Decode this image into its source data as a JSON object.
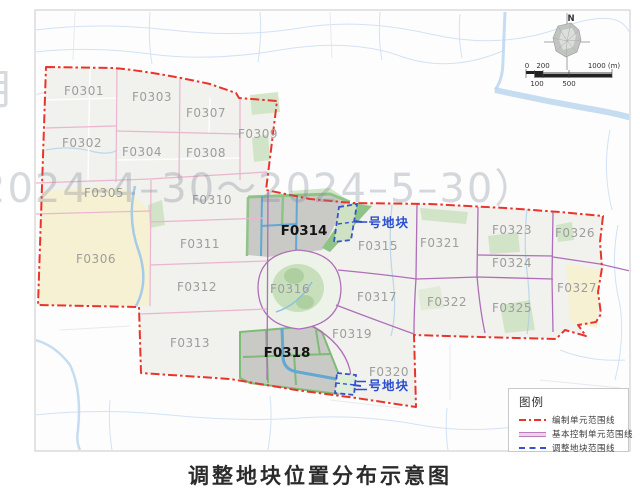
{
  "title": "调整地块位置分布示意图",
  "map": {
    "north_label": "N",
    "watermark": {
      "main": "（2024–4–30～2024–5–30）",
      "left_fragment": "月"
    },
    "parcels": [
      {
        "id": "F0301",
        "label": "F0301",
        "x": 84,
        "y": 95,
        "style": "gray"
      },
      {
        "id": "F0303",
        "label": "F0303",
        "x": 152,
        "y": 101,
        "style": "gray"
      },
      {
        "id": "F0307",
        "label": "F0307",
        "x": 206,
        "y": 117,
        "style": "gray"
      },
      {
        "id": "F0309",
        "label": "F0309",
        "x": 258,
        "y": 138,
        "style": "gray"
      },
      {
        "id": "F0302",
        "label": "F0302",
        "x": 82,
        "y": 147,
        "style": "gray"
      },
      {
        "id": "F0304",
        "label": "F0304",
        "x": 142,
        "y": 156,
        "style": "gray"
      },
      {
        "id": "F0308",
        "label": "F0308",
        "x": 206,
        "y": 157,
        "style": "gray"
      },
      {
        "id": "F0305",
        "label": "F0305",
        "x": 104,
        "y": 197,
        "style": "gray"
      },
      {
        "id": "F0310",
        "label": "F0310",
        "x": 212,
        "y": 204,
        "style": "gray"
      },
      {
        "id": "F0311",
        "label": "F0311",
        "x": 200,
        "y": 248,
        "style": "gray"
      },
      {
        "id": "F0306",
        "label": "F0306",
        "x": 96,
        "y": 263,
        "style": "gray"
      },
      {
        "id": "F0312",
        "label": "F0312",
        "x": 197,
        "y": 291,
        "style": "gray"
      },
      {
        "id": "F0313",
        "label": "F0313",
        "x": 190,
        "y": 347,
        "style": "gray"
      },
      {
        "id": "F0314",
        "label": "F0314",
        "x": 304,
        "y": 235,
        "style": "bold"
      },
      {
        "id": "F0315",
        "label": "F0315",
        "x": 378,
        "y": 250,
        "style": "gray"
      },
      {
        "id": "F0316",
        "label": "F0316",
        "x": 290,
        "y": 293,
        "style": "gray"
      },
      {
        "id": "F0317",
        "label": "F0317",
        "x": 377,
        "y": 301,
        "style": "gray"
      },
      {
        "id": "F0319",
        "label": "F0319",
        "x": 352,
        "y": 338,
        "style": "gray"
      },
      {
        "id": "F0318",
        "label": "F0318",
        "x": 287,
        "y": 357,
        "style": "bold"
      },
      {
        "id": "F0320",
        "label": "F0320",
        "x": 389,
        "y": 376,
        "style": "gray"
      },
      {
        "id": "F0321",
        "label": "F0321",
        "x": 440,
        "y": 247,
        "style": "gray"
      },
      {
        "id": "F0322",
        "label": "F0322",
        "x": 447,
        "y": 306,
        "style": "gray"
      },
      {
        "id": "F0323",
        "label": "F0323",
        "x": 512,
        "y": 234,
        "style": "gray"
      },
      {
        "id": "F0324",
        "label": "F0324",
        "x": 512,
        "y": 267,
        "style": "gray"
      },
      {
        "id": "F0325",
        "label": "F0325",
        "x": 512,
        "y": 312,
        "style": "gray"
      },
      {
        "id": "F0326",
        "label": "F0326",
        "x": 575,
        "y": 237,
        "style": "gray"
      },
      {
        "id": "F0327",
        "label": "F0327",
        "x": 577,
        "y": 292,
        "style": "gray"
      },
      {
        "id": "plot-1",
        "label": "一号地块",
        "x": 382,
        "y": 227,
        "style": "blue"
      },
      {
        "id": "plot-2",
        "label": "二号地块",
        "x": 382,
        "y": 390,
        "style": "blue"
      }
    ],
    "scalebar": {
      "top_labels": [
        {
          "t": "0",
          "x": 527
        },
        {
          "t": "200",
          "x": 543
        },
        {
          "t": "1000 (m)",
          "x": 604
        }
      ],
      "bottom_labels": [
        {
          "t": "100",
          "x": 537
        },
        {
          "t": "500",
          "x": 569
        }
      ]
    }
  },
  "legend": {
    "title": "图例",
    "items": [
      {
        "label": "编制单元范围线",
        "swatch": "red-dashdot"
      },
      {
        "label": "基本控制单元范围线",
        "swatch": "pink-solid"
      },
      {
        "label": "调整地块范围线",
        "swatch": "blue-dash"
      }
    ]
  },
  "colors": {
    "boundary_red": "#e8352c",
    "unit_line_pink": "#eab5ce",
    "control_line_purple": "#ae6eb8",
    "adjust_parcel_blue": "#3752cc",
    "highlight_label_blue": "#2b4fd0",
    "block_gray": "#c9c9c6",
    "greenway_green": "#8ec487",
    "water_blue": "#bcd6ee",
    "farmland_yellow": "#f6f1d3"
  }
}
